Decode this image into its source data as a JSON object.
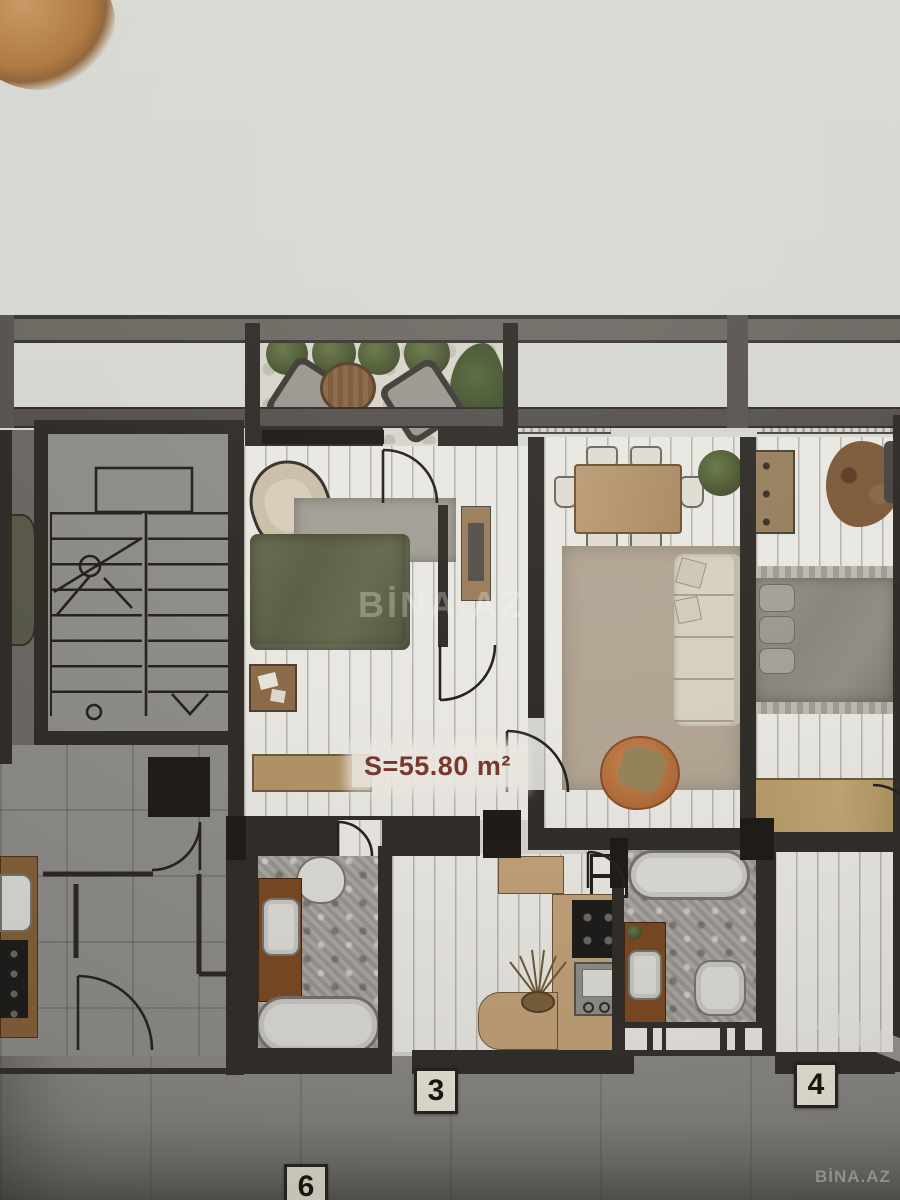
{
  "photo": {
    "watermark_center": "BİNA.AZ",
    "watermark_corner": "BİNA.AZ"
  },
  "plan": {
    "area_label": "S=55.80 m²",
    "unit_badges": {
      "unit_3": "3",
      "unit_4": "4",
      "unit_6": "6"
    },
    "colors": {
      "paper": "#d6d7d1",
      "wall": "#312d29",
      "wall_band": "#6e6963",
      "plank_floor": "#e9e7e1",
      "gray_floor": "#8a8886",
      "bathroom_tile": "#a09d98",
      "bed_olive": "#616449",
      "bed_gray": "#8e8a84",
      "sofa_cream": "#d7d0c0",
      "armchair_orange": "#bb7747",
      "wood_light": "#c0a078",
      "wood_vanity": "#7a4822",
      "plant_green": "#50603a",
      "area_label_text": "#7a382c"
    },
    "furniture_icons": [
      "stairs-icon",
      "bed-icon",
      "sofa-icon",
      "armchair-icon",
      "dining-table-icon",
      "chair-icon",
      "bathtub-icon",
      "toilet-icon",
      "sink-icon",
      "cooktop-icon",
      "fridge-icon",
      "plant-icon",
      "rug-icon",
      "door-swing-icon",
      "bench-icon",
      "dresser-icon"
    ]
  }
}
